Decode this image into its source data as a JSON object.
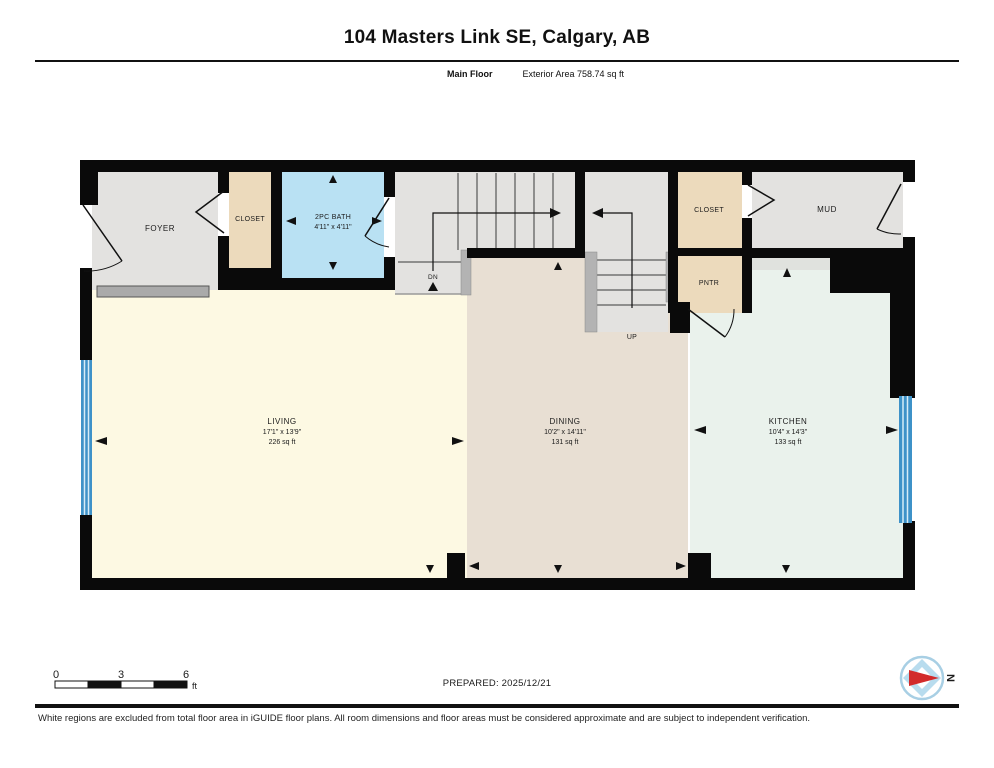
{
  "header": {
    "title": "104 Masters Link SE, Calgary, AB",
    "floor_label": "Main Floor",
    "area_label": "Exterior Area 758.74 sq ft"
  },
  "rooms": {
    "foyer": {
      "name": "FOYER"
    },
    "closet_left": {
      "name": "CLOSET"
    },
    "bath": {
      "name": "2PC BATH",
      "dims": "4'11\" x 4'11\""
    },
    "stairs_down": {
      "label": "DN"
    },
    "stairs_up": {
      "label": "UP"
    },
    "closet_right": {
      "name": "CLOSET"
    },
    "mud": {
      "name": "MUD"
    },
    "pantry": {
      "name": "PNTR"
    },
    "living": {
      "name": "LIVING",
      "dims": "17'1\" x 13'9\"",
      "area": "226 sq ft"
    },
    "dining": {
      "name": "DINING",
      "dims": "10'2\" x 14'11\"",
      "area": "131 sq ft"
    },
    "kitchen": {
      "name": "KITCHEN",
      "dims": "10'4\" x 14'3\"",
      "area": "133 sq ft"
    }
  },
  "scale_bar": {
    "ticks": [
      "0",
      "3",
      "6"
    ],
    "unit": "ft"
  },
  "compass": {
    "north_label": "N"
  },
  "footer": {
    "prepared": "PREPARED: 2025/12/21",
    "disclaimer": "White regions are excluded from total floor area in iGUIDE floor plans. All room dimensions and floor areas must be considered approximate and are subject to independent verification."
  },
  "colors": {
    "wall": "#0a0a0a",
    "gray_room": "#e3e2e0",
    "closet": "#ecdabc",
    "bath": "#b9e1f3",
    "living": "#fdf9e3",
    "dining": "#e8dfd3",
    "kitchen": "#eaf2ec",
    "hall_strip": "#e0e2de",
    "window": "#3e92c8",
    "compass_red": "#d22b2b",
    "compass_blue": "#b8dcee"
  }
}
